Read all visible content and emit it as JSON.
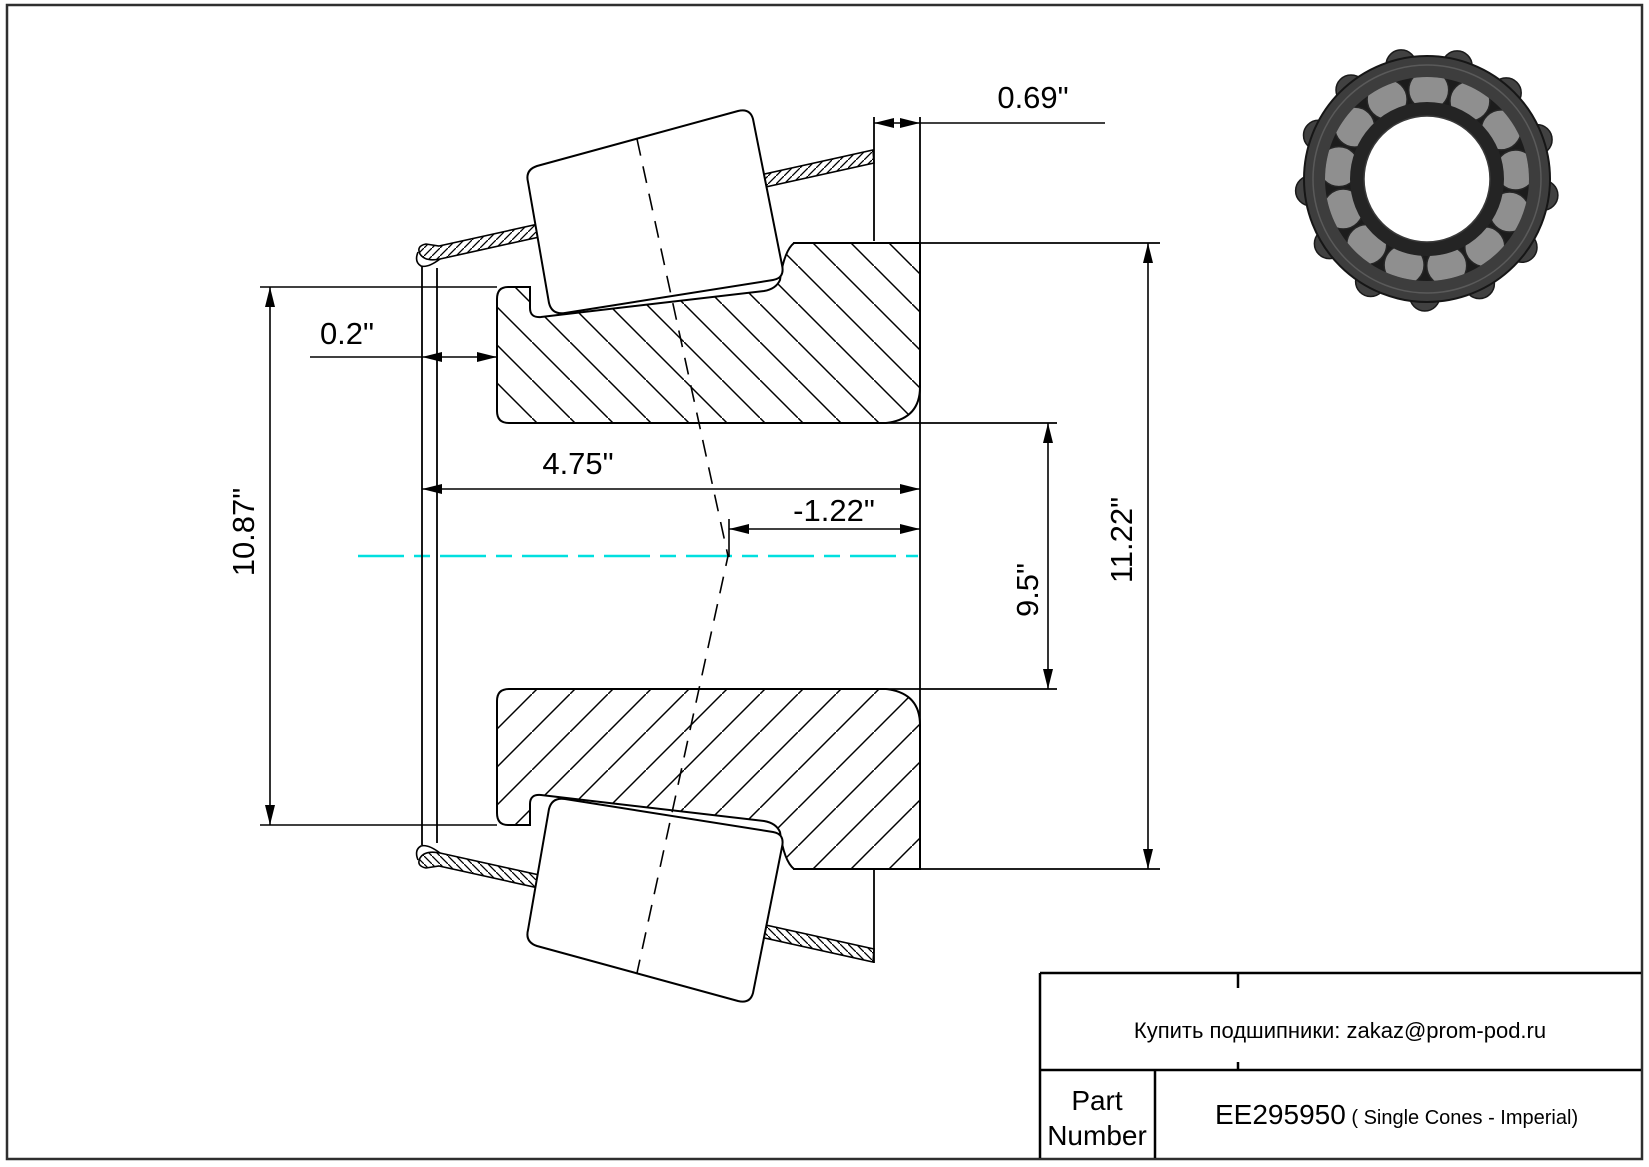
{
  "sheet": {
    "border_color": "#2f2f2f",
    "background": "#ffffff"
  },
  "drawing": {
    "type": "tapered-roller-bearing-single-cone-cross-section",
    "centerline_color": "#00dfdf",
    "line_color": "#000000",
    "dimensions": {
      "back_face_standout": "0.69\"",
      "front_standout": "0.2\"",
      "cone_width": "4.75\"",
      "effective_center": "-1.22\"",
      "front_outer_diameter": "10.87\"",
      "bore_diameter": "9.5\"",
      "outer_diameter": "11.22\""
    }
  },
  "title_block": {
    "note": "Купить подшипники: zakaz@prom-pod.ru",
    "part_label_line1": "Part",
    "part_label_line2": "Number",
    "part_number": "EE295950",
    "part_suffix": " ( Single Cones - Imperial)"
  },
  "bearing_photo": {
    "ring_color": "#3d3d3d",
    "roller_color": "#8f8f8f",
    "bore_color": "#ffffff"
  }
}
